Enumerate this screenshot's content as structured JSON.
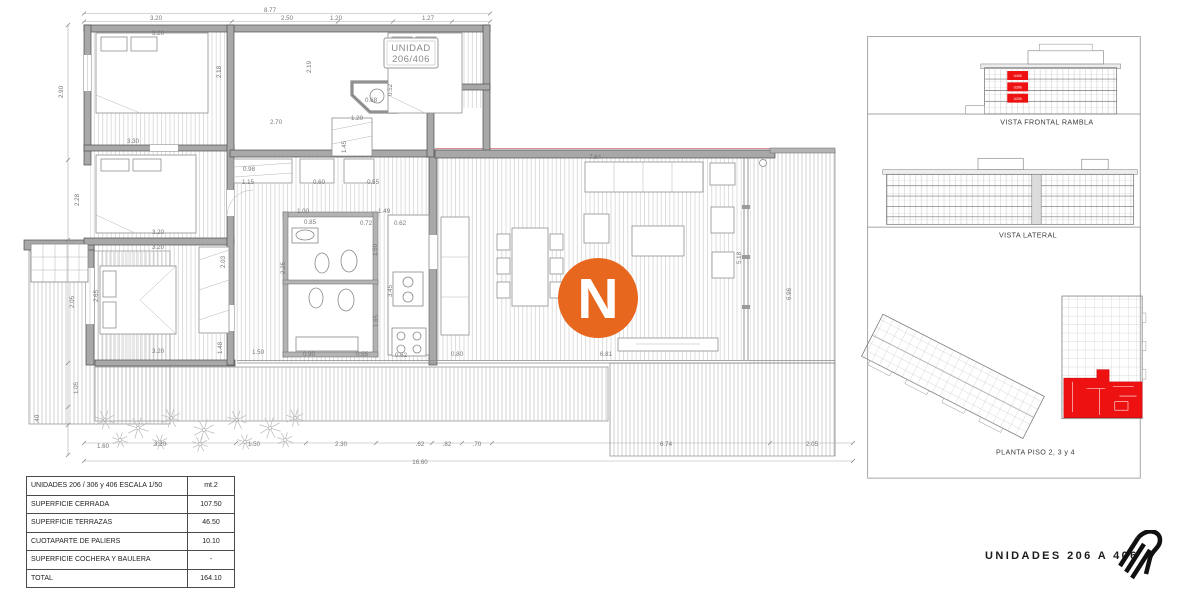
{
  "plan": {
    "unit_box": {
      "line1": "UNIDAD",
      "line2": "206/406"
    },
    "north": "N",
    "dim_labels": [
      {
        "t": "8.77",
        "x": 270,
        "y": 12
      },
      {
        "t": "3.20",
        "x": 156,
        "y": 20
      },
      {
        "t": "2.50",
        "x": 287,
        "y": 20
      },
      {
        "t": "1.20",
        "x": 336,
        "y": 20
      },
      {
        "t": "1.27",
        "x": 428,
        "y": 20
      },
      {
        "t": "3.20",
        "x": 158,
        "y": 35
      },
      {
        "t": "2.18",
        "x": 221,
        "y": 72,
        "v": 1
      },
      {
        "t": "2.19",
        "x": 311,
        "y": 67,
        "v": 1
      },
      {
        "t": "0.68",
        "x": 371,
        "y": 102
      },
      {
        "t": "0.52",
        "x": 392,
        "y": 90,
        "v": 1
      },
      {
        "t": "2.70",
        "x": 276,
        "y": 124
      },
      {
        "t": "1.20",
        "x": 357,
        "y": 120
      },
      {
        "t": "1.45",
        "x": 346,
        "y": 147,
        "v": 1
      },
      {
        "t": "3.30",
        "x": 133,
        "y": 143
      },
      {
        "t": "0.98",
        "x": 249,
        "y": 171
      },
      {
        "t": "1.15",
        "x": 248,
        "y": 184
      },
      {
        "t": "0.60",
        "x": 319,
        "y": 184
      },
      {
        "t": "0.55",
        "x": 373,
        "y": 184
      },
      {
        "t": "2.90",
        "x": 63,
        "y": 92,
        "v": 1
      },
      {
        "t": "2.28",
        "x": 79,
        "y": 200,
        "v": 1
      },
      {
        "t": "2.05",
        "x": 74,
        "y": 302,
        "v": 1
      },
      {
        "t": "1.05",
        "x": 78,
        "y": 388,
        "v": 1
      },
      {
        "t": ".40",
        "x": 39,
        "y": 419,
        "v": 1
      },
      {
        "t": "1.60",
        "x": 103,
        "y": 448
      },
      {
        "t": "3.20",
        "x": 158,
        "y": 234
      },
      {
        "t": "3.20",
        "x": 158,
        "y": 249
      },
      {
        "t": "2.03",
        "x": 225,
        "y": 262,
        "v": 1
      },
      {
        "t": "2.65",
        "x": 98,
        "y": 296,
        "v": 1
      },
      {
        "t": "1.48",
        "x": 222,
        "y": 348,
        "v": 1
      },
      {
        "t": "3.20",
        "x": 158,
        "y": 353
      },
      {
        "t": "1.00",
        "x": 303,
        "y": 213
      },
      {
        "t": "0.85",
        "x": 310,
        "y": 224
      },
      {
        "t": "1.49",
        "x": 384,
        "y": 213
      },
      {
        "t": "0.72",
        "x": 366,
        "y": 225
      },
      {
        "t": "0.62",
        "x": 400,
        "y": 225
      },
      {
        "t": "2.25",
        "x": 285,
        "y": 268,
        "v": 1
      },
      {
        "t": "1.50",
        "x": 377,
        "y": 250,
        "v": 1
      },
      {
        "t": "3.45",
        "x": 392,
        "y": 291,
        "v": 1
      },
      {
        "t": "1.65",
        "x": 378,
        "y": 321,
        "v": 1
      },
      {
        "t": "0.90",
        "x": 309,
        "y": 356
      },
      {
        "t": "0.55",
        "x": 362,
        "y": 356
      },
      {
        "t": "0.62",
        "x": 401,
        "y": 357
      },
      {
        "t": "1.50",
        "x": 258,
        "y": 354
      },
      {
        "t": "7.64",
        "x": 595,
        "y": 159
      },
      {
        "t": "5.18",
        "x": 741,
        "y": 258,
        "v": 1
      },
      {
        "t": "6.81",
        "x": 606,
        "y": 356
      },
      {
        "t": "6.96",
        "x": 791,
        "y": 294,
        "v": 1
      },
      {
        "t": "0.80",
        "x": 457,
        "y": 356
      },
      {
        "t": "3.20",
        "x": 160,
        "y": 446
      },
      {
        "t": "1.50",
        "x": 254,
        "y": 446
      },
      {
        "t": "2.30",
        "x": 341,
        "y": 446
      },
      {
        "t": ".62",
        "x": 420,
        "y": 446
      },
      {
        "t": ".82",
        "x": 447,
        "y": 446
      },
      {
        "t": ".70",
        "x": 477,
        "y": 446
      },
      {
        "t": "6.74",
        "x": 666,
        "y": 446
      },
      {
        "t": "2.05",
        "x": 812,
        "y": 446
      },
      {
        "t": "16.60",
        "x": 420,
        "y": 464
      }
    ]
  },
  "summary_table": {
    "rows": [
      {
        "label": "UNIDADES 206 / 306 y 406  ESCALA 1/50",
        "value": "mt.2"
      },
      {
        "label": "SUPERFICIE  CERRADA",
        "value": "107.50"
      },
      {
        "label": "SUPERFICIE  TERRAZAS",
        "value": "46.50"
      },
      {
        "label": "CUOTAPARTE DE PALIERS",
        "value": "10.10"
      },
      {
        "label": "SUPERFICIE COCHERA Y BAULERA",
        "value": "-"
      },
      {
        "label": "TOTAL",
        "value": "164.10"
      }
    ]
  },
  "sidebar": {
    "panels": [
      {
        "caption": "VISTA FRONTAL RAMBLA",
        "unit_tags": [
          "U406",
          "U306",
          "U206"
        ]
      },
      {
        "caption": "VISTA LATERAL"
      },
      {
        "caption": "PLANTA PISO 2, 3 y 4"
      }
    ]
  },
  "footer": {
    "label": "UNIDADES 206 A 406"
  },
  "colors": {
    "north_orange": "#E8671F",
    "highlight_red": "#EE1111"
  }
}
